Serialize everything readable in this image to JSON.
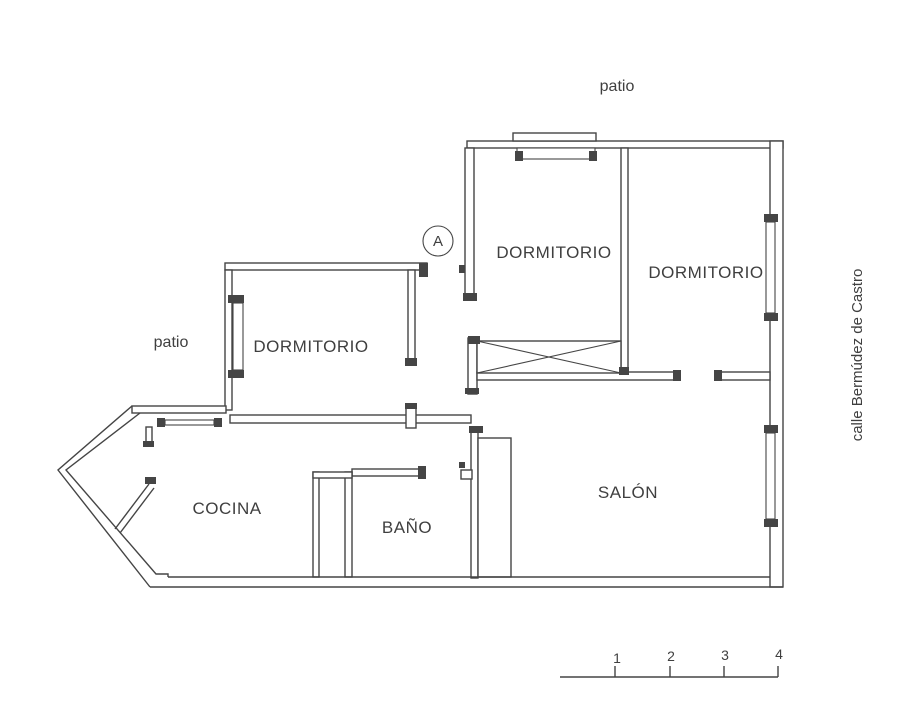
{
  "colors": {
    "wall": "#454545",
    "text": "#3f3f3f",
    "background": "#ffffff"
  },
  "labels": {
    "patio_top": "patio",
    "patio_left": "patio",
    "street": "calle Bermúdez de Castro",
    "marker": "A"
  },
  "rooms": [
    {
      "name": "DORMITORIO",
      "position": "middle-left"
    },
    {
      "name": "DORMITORIO",
      "position": "top-middle"
    },
    {
      "name": "DORMITORIO",
      "position": "top-right"
    },
    {
      "name": "COCINA",
      "position": "bottom-left"
    },
    {
      "name": "BAÑO",
      "position": "bottom-middle"
    },
    {
      "name": "SALÓN",
      "position": "bottom-right"
    }
  ],
  "scale_bar": {
    "ticks": [
      "1",
      "2",
      "3",
      "4"
    ]
  }
}
